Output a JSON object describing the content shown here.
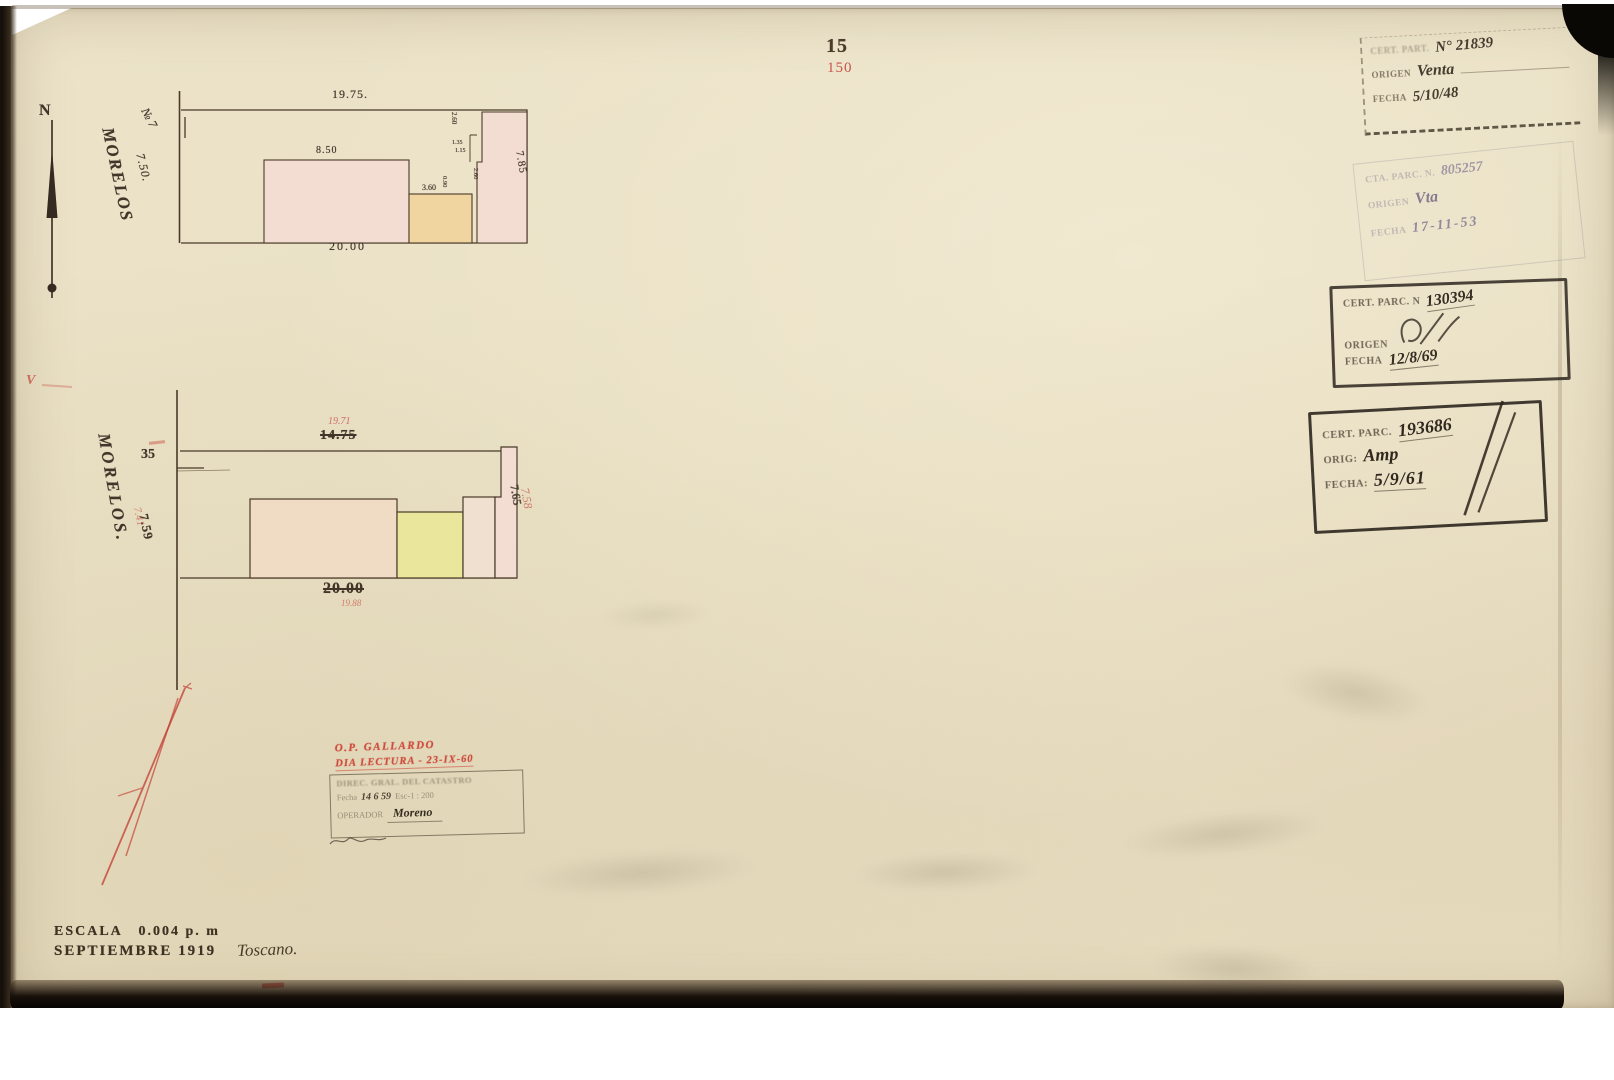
{
  "document": {
    "sheet_number": "15",
    "sheet_number_red": "150",
    "north_label": "N",
    "escala_line": "ESCALA   0.004 p. m",
    "fecha_line": "SEPTIEMBRE 1919",
    "author_signature": "Toscano.",
    "red_check": "V"
  },
  "diagram_top": {
    "street_name": "MORELOS",
    "house_number": "№ 7",
    "front_dim": "7.50.",
    "top_dim": "19.75.",
    "bottom_dim": "20.00",
    "right_dim": "7.85",
    "building_dim": "8.50",
    "patio_dim": "3.60",
    "small_dims": [
      "2.60",
      "1.35",
      "1.15",
      "0.90",
      "2.60"
    ]
  },
  "diagram_bottom": {
    "street_name": "MORELOS.",
    "house_number": "35",
    "top_dim_old": "14.75",
    "top_dim_red": "19.71",
    "bottom_dim_old": "20.00",
    "bottom_dim_red": "19.88",
    "left_dim_old": "7.59",
    "left_dim_red": "7.41",
    "right_dim_old": "7.65",
    "right_dim_red": "7.58"
  },
  "red_annotation": {
    "line1": "O.P. GALLARDO",
    "line2": "DIA LECTURA - 23-IX-60"
  },
  "survey_stamp": {
    "header": "DIREC. GRAL. DEL CATASTRO",
    "fecha_label": "Fecha",
    "fecha_value": "14  6  59",
    "esc_text": "Esc-1 : 200",
    "operador_label": "OPERADOR",
    "operador_value": "Moreno"
  },
  "stamps": {
    "s1": {
      "l1_label": "CERT. PART.",
      "l1_value": "N° 21839",
      "l2_label": "ORIGEN",
      "l2_value": "Venta",
      "l3_label": "FECHA",
      "l3_value": "5/10/48"
    },
    "s2": {
      "l1_label": "CTA. PARC. N.",
      "l1_value": "805257",
      "l2_label": "ORIGEN",
      "l2_value": "Vta",
      "l3_label": "FECHA",
      "l3_value": "17-11-53"
    },
    "s3": {
      "l1_label": "CERT. PARC. N",
      "l1_value": "130394",
      "l2_label": "ORIGEN",
      "l3_label": "FECHA",
      "l3_value": "12/8/69"
    },
    "s4": {
      "l1_label": "CERT. PARC.",
      "l1_value": "193686",
      "l2_label": "ORIG:",
      "l2_value": "Amp",
      "l3_label": "FECHA:",
      "l3_value": "5/9/61"
    }
  }
}
